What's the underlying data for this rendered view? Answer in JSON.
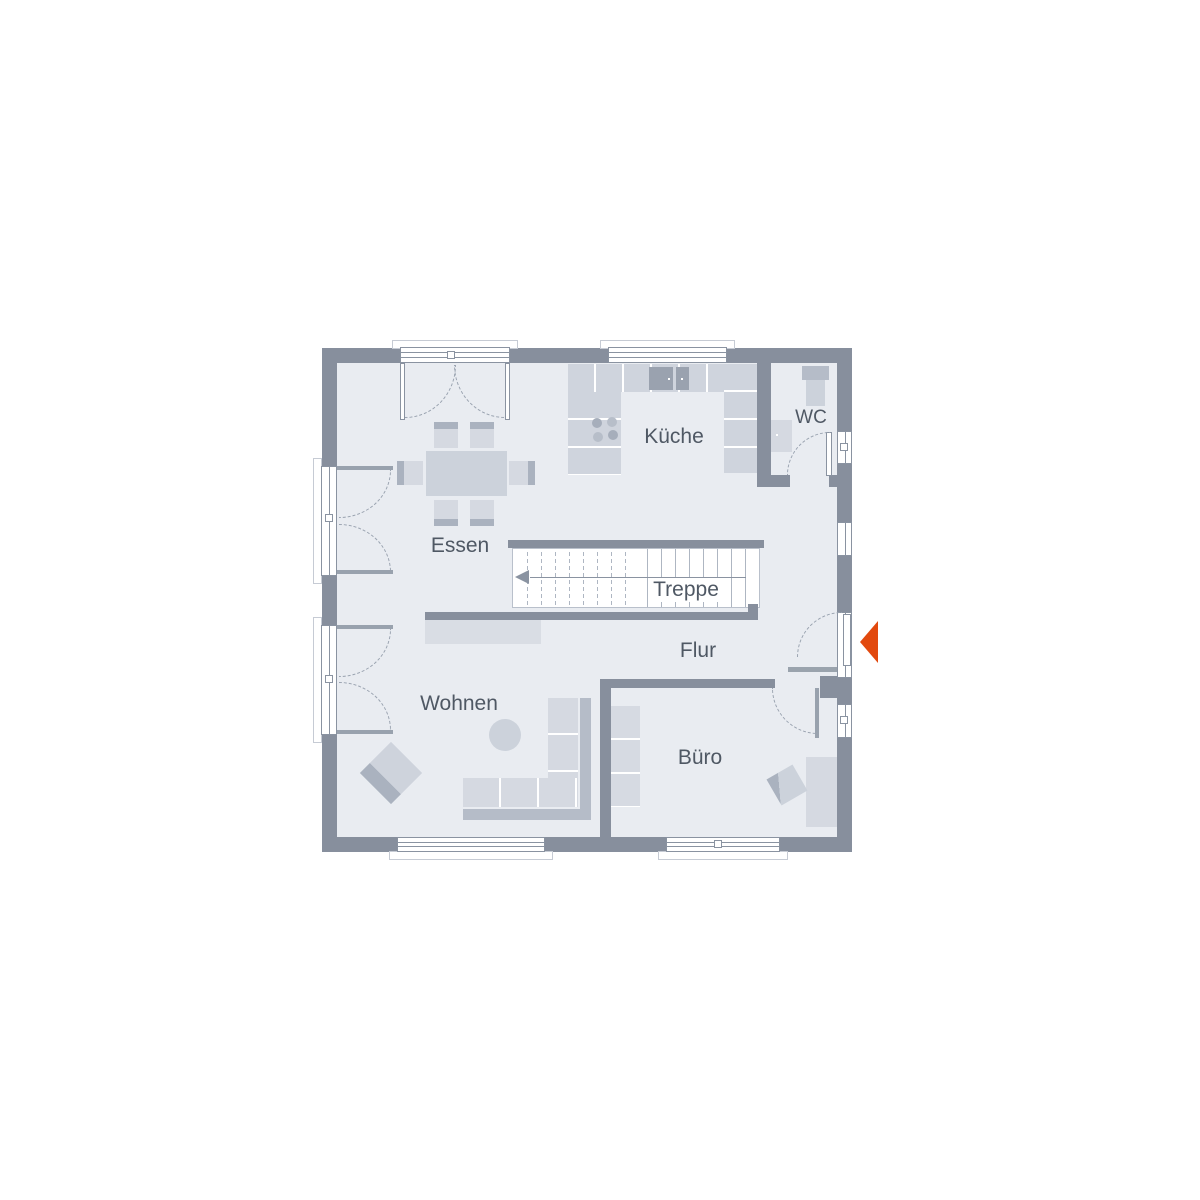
{
  "rooms": {
    "kueche": {
      "label": "Küche"
    },
    "wc": {
      "label": "WC"
    },
    "essen": {
      "label": "Essen"
    },
    "treppe": {
      "label": "Treppe"
    },
    "flur": {
      "label": "Flur"
    },
    "wohnen": {
      "label": "Wohnen"
    },
    "buero": {
      "label": "Büro"
    }
  },
  "icons": {
    "entry_arrow": "left-pointing entrance arrow"
  },
  "colors": {
    "wall": "#878f9d",
    "wall_light": "#9aa3ad",
    "floor": "#e9ecf1",
    "stair_bg": "#ffffff",
    "stair_line": "#aeb6c2",
    "counter": "#cfd4dd",
    "furniture": "#d5d9e1",
    "furniture_mid": "#ccd2db",
    "accent": "#aab2bf",
    "dark_item": "#9aa2af",
    "back": "#b5bcc8",
    "leaf_strip": "#99a2ae",
    "glass_line": "#8a93a1",
    "dash": "#9aa3b0",
    "text": "#4f5864",
    "entry": "#e2490e"
  }
}
